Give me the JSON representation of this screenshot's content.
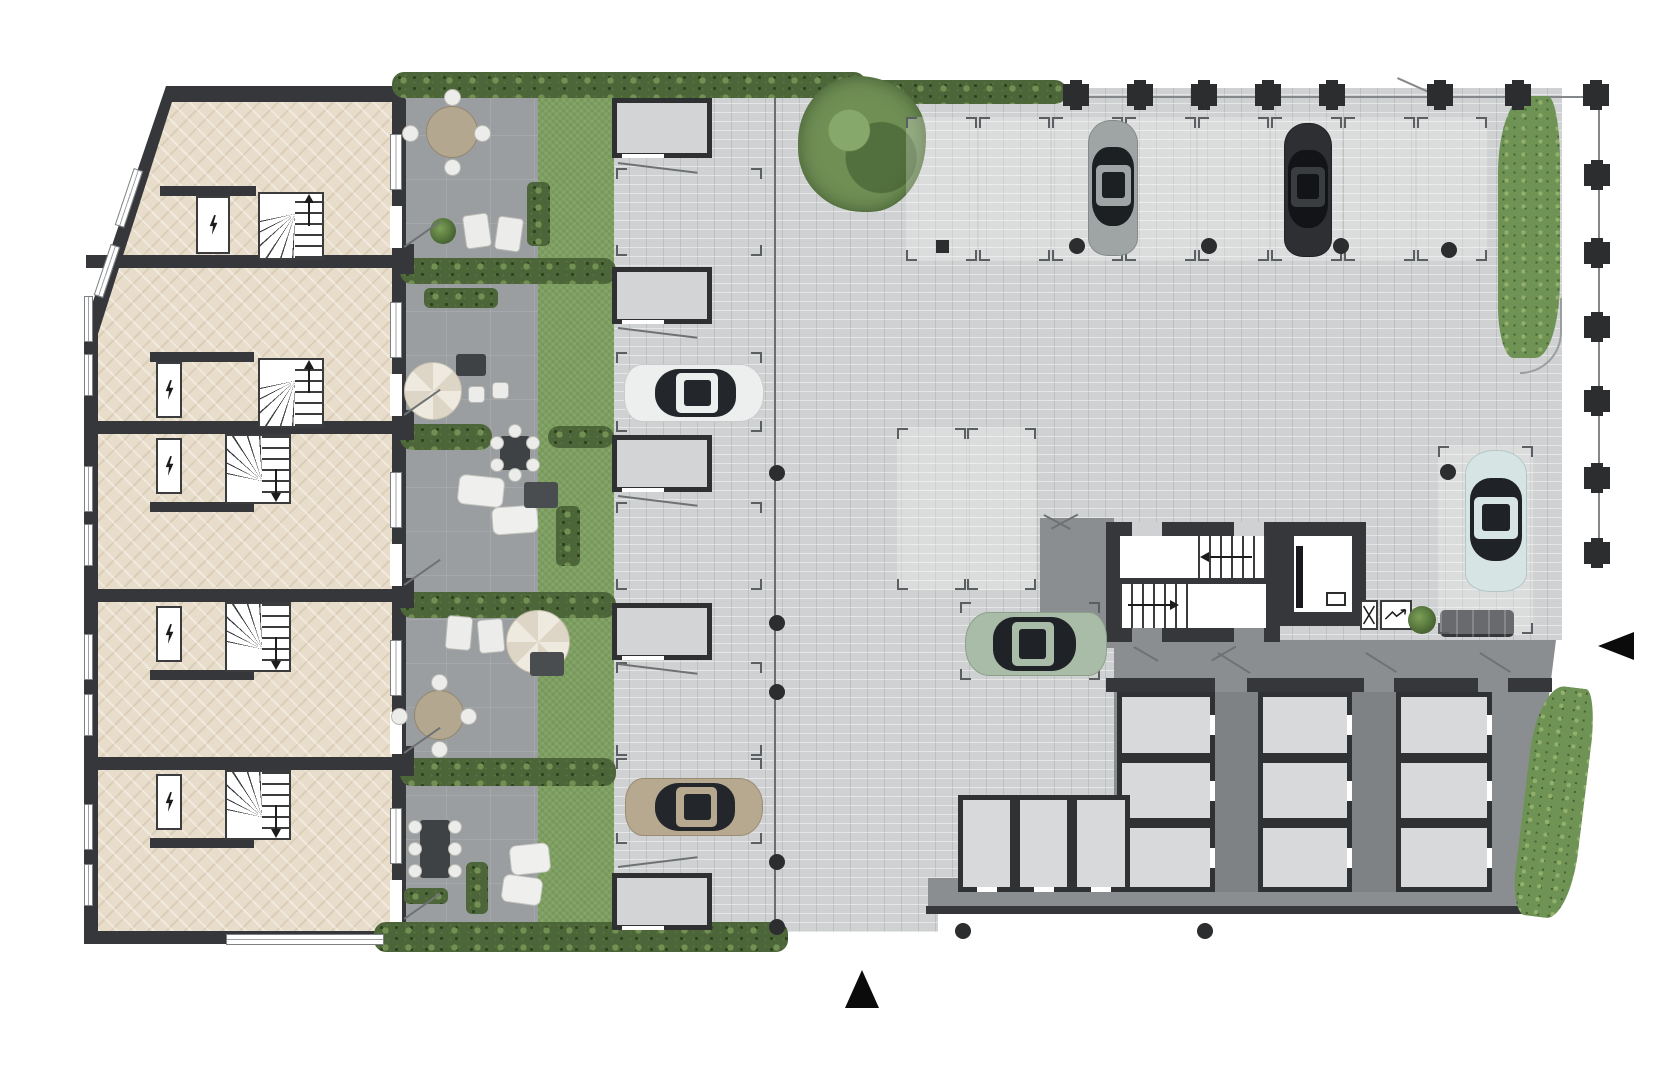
{
  "meta": {
    "name": "ground-floor-site-plan",
    "visible_text": []
  },
  "palette": {
    "wall": "#35373a",
    "wall_dark": "#2b2d2f",
    "apartment_floor": "#e8ddca",
    "terrace": "#9b9ea0",
    "lawn": "#7d9f60",
    "hedge": "#4d6639",
    "paving": "#cfd1d2",
    "walkway": "#8b8e90",
    "corridor": "#7f8285",
    "storage_cell": "#d8d9da",
    "garage": "#d3d4d5",
    "background": "#ffffff"
  },
  "site": {
    "building": {
      "dividers": [
        [
          86,
          255,
          316,
          13
        ],
        [
          86,
          421,
          316,
          13
        ],
        [
          86,
          589,
          316,
          13
        ],
        [
          86,
          757,
          316,
          13
        ]
      ],
      "units": [
        {
          "id": "unit-1",
          "y": 100,
          "hall": "bottom",
          "stair": [
            258,
            192,
            66,
            68
          ],
          "closet": [
            196,
            196,
            34,
            58
          ],
          "hallwall": [
            160,
            186,
            96,
            10
          ],
          "win": [
            390,
            134,
            12,
            56
          ],
          "door": [
            390,
            206,
            12,
            42
          ]
        },
        {
          "id": "unit-2",
          "y": 268,
          "hall": "bottom",
          "stair": [
            258,
            358,
            66,
            70
          ],
          "closet": [
            156,
            362,
            26,
            56
          ],
          "hallwall": [
            150,
            352,
            104,
            10
          ],
          "win": [
            390,
            302,
            12,
            56
          ],
          "door": [
            390,
            374,
            12,
            42
          ]
        },
        {
          "id": "unit-3",
          "y": 436,
          "hall": "top",
          "stair": [
            225,
            434,
            66,
            70
          ],
          "closet": [
            156,
            438,
            26,
            56
          ],
          "hallwall": [
            150,
            502,
            104,
            10
          ],
          "win": [
            390,
            472,
            12,
            56
          ],
          "door": [
            390,
            544,
            12,
            42
          ]
        },
        {
          "id": "unit-4",
          "y": 604,
          "hall": "top",
          "stair": [
            225,
            602,
            66,
            70
          ],
          "closet": [
            156,
            606,
            26,
            56
          ],
          "hallwall": [
            150,
            670,
            104,
            10
          ],
          "win": [
            390,
            640,
            12,
            56
          ],
          "door": [
            390,
            712,
            12,
            42
          ]
        },
        {
          "id": "unit-5",
          "y": 772,
          "hall": "top",
          "stair": [
            225,
            770,
            66,
            70
          ],
          "closet": [
            156,
            774,
            26,
            56
          ],
          "hallwall": [
            150,
            838,
            104,
            10
          ],
          "win": [
            390,
            808,
            12,
            56
          ],
          "door": [
            390,
            880,
            12,
            42
          ]
        }
      ],
      "windows_left": [
        [
          84,
          296,
          9,
          46,
          0
        ],
        [
          84,
          354,
          9,
          42,
          0
        ],
        [
          84,
          466,
          9,
          46,
          0
        ],
        [
          84,
          524,
          9,
          42,
          0
        ],
        [
          84,
          634,
          9,
          46,
          0
        ],
        [
          84,
          694,
          9,
          42,
          0
        ],
        [
          84,
          804,
          9,
          46,
          0
        ],
        [
          84,
          864,
          9,
          42,
          0
        ],
        [
          124,
          168,
          10,
          60,
          18.5
        ],
        [
          102,
          244,
          10,
          54,
          18.5
        ]
      ],
      "window_bottom": [
        226,
        934,
        158,
        11
      ],
      "piers": [
        [
          398,
          244,
          16,
          30
        ],
        [
          398,
          410,
          16,
          30
        ],
        [
          398,
          578,
          16,
          30
        ],
        [
          398,
          746,
          16,
          30
        ]
      ]
    },
    "hedges": [
      [
        392,
        72,
        474,
        26
      ],
      [
        863,
        80,
        204,
        24
      ],
      [
        400,
        258,
        216,
        26
      ],
      [
        400,
        424,
        92,
        26
      ],
      [
        548,
        426,
        66,
        22
      ],
      [
        400,
        592,
        216,
        26
      ],
      [
        400,
        758,
        216,
        28
      ],
      [
        374,
        922,
        414,
        30
      ]
    ],
    "grass": [
      [
        1498,
        96,
        62,
        262,
        0
      ],
      [
        1524,
        686,
        60,
        232,
        7
      ]
    ],
    "tree": [
      798,
      76,
      128,
      136
    ],
    "furniture": [
      {
        "t": "round-table",
        "x": 426,
        "y": 106,
        "w": 52,
        "h": 52
      },
      {
        "t": "lounge-pair",
        "x": 464,
        "y": 214,
        "w": 58,
        "h": 34,
        "r": -8
      },
      {
        "t": "planter",
        "x": 527,
        "y": 182,
        "w": 23,
        "h": 64
      },
      {
        "t": "plant",
        "x": 430,
        "y": 218,
        "w": 26,
        "h": 26
      },
      {
        "t": "planter",
        "x": 424,
        "y": 288,
        "w": 74,
        "h": 20
      },
      {
        "t": "parasol",
        "x": 404,
        "y": 362,
        "w": 58,
        "h": 58
      },
      {
        "t": "small-table",
        "x": 456,
        "y": 354,
        "w": 30,
        "h": 22
      },
      {
        "t": "chair",
        "x": 468,
        "y": 386,
        "w": 17,
        "h": 17
      },
      {
        "t": "chair",
        "x": 492,
        "y": 382,
        "w": 17,
        "h": 17
      },
      {
        "t": "dining-s",
        "x": 492,
        "y": 430,
        "w": 46,
        "h": 46
      },
      {
        "t": "sofa",
        "x": 458,
        "y": 476,
        "w": 46,
        "h": 30,
        "r": 6
      },
      {
        "t": "sofa",
        "x": 492,
        "y": 506,
        "w": 46,
        "h": 28,
        "r": -4
      },
      {
        "t": "mat",
        "x": 524,
        "y": 482,
        "w": 34,
        "h": 26
      },
      {
        "t": "planter",
        "x": 556,
        "y": 506,
        "w": 24,
        "h": 60
      },
      {
        "t": "lounge-pair",
        "x": 446,
        "y": 616,
        "w": 58,
        "h": 34,
        "r": 5
      },
      {
        "t": "parasol",
        "x": 506,
        "y": 610,
        "w": 64,
        "h": 64
      },
      {
        "t": "mat",
        "x": 530,
        "y": 652,
        "w": 34,
        "h": 24
      },
      {
        "t": "round-table",
        "x": 414,
        "y": 690,
        "w": 50,
        "h": 50
      },
      {
        "t": "dining-v",
        "x": 412,
        "y": 816,
        "w": 46,
        "h": 66
      },
      {
        "t": "sofa",
        "x": 510,
        "y": 844,
        "w": 40,
        "h": 30,
        "r": -6
      },
      {
        "t": "sofa",
        "x": 502,
        "y": 876,
        "w": 40,
        "h": 28,
        "r": 8
      },
      {
        "t": "planter",
        "x": 466,
        "y": 862,
        "w": 22,
        "h": 52
      },
      {
        "t": "planter",
        "x": 404,
        "y": 888,
        "w": 44,
        "h": 16
      }
    ],
    "garages": [
      [
        612,
        98,
        100,
        60
      ],
      [
        612,
        267,
        100,
        57
      ],
      [
        612,
        435,
        100,
        57
      ],
      [
        612,
        603,
        100,
        57
      ],
      [
        612,
        873,
        100,
        57
      ]
    ],
    "cars": [
      {
        "name": "car-white",
        "x": 694,
        "y": 393,
        "len": 140,
        "wid": 58,
        "heading": "right",
        "body": "#edeeee",
        "glass": "#23262a",
        "trim": "#c9cccc",
        "roof": "#edeeee"
      },
      {
        "name": "car-tan",
        "x": 694,
        "y": 807,
        "len": 138,
        "wid": 58,
        "heading": "right",
        "body": "#b6a98f",
        "glass": "#23262a",
        "trim": "#998c72",
        "roof": "#b6a98f"
      },
      {
        "name": "car-gray",
        "x": 1113,
        "y": 188,
        "len": 136,
        "wid": 50,
        "heading": "up",
        "body": "#9fa5a5",
        "glass": "#1d2023",
        "trim": "#848a8a",
        "roof": "#9fa5a5"
      },
      {
        "name": "car-black",
        "x": 1308,
        "y": 190,
        "len": 134,
        "wid": 48,
        "heading": "up",
        "body": "#2d2f32",
        "glass": "#121417",
        "trim": "#202224",
        "roof": "#3a3d40"
      },
      {
        "name": "car-blue",
        "x": 1496,
        "y": 521,
        "len": 142,
        "wid": 62,
        "heading": "up",
        "body": "#d7e4e4",
        "glass": "#1f2226",
        "trim": "#b5c6c6",
        "roof": "#d7e4e4"
      },
      {
        "name": "car-green",
        "x": 1036,
        "y": 644,
        "len": 142,
        "wid": 64,
        "heading": "left",
        "body": "#a9bca7",
        "glass": "#1f2226",
        "trim": "#8ba08a",
        "roof": "#a9bca7"
      }
    ],
    "bollards": [
      [
        777,
        473
      ],
      [
        777,
        623
      ],
      [
        777,
        692
      ],
      [
        777,
        862
      ],
      [
        777,
        927
      ],
      [
        1077,
        246
      ],
      [
        1209,
        246
      ],
      [
        1341,
        246
      ],
      [
        1449,
        250
      ],
      [
        1448,
        472
      ],
      [
        963,
        931
      ],
      [
        1205,
        931
      ]
    ],
    "posts": [
      [
        936,
        240,
        13,
        13
      ]
    ],
    "columns": {
      "top_y": 84,
      "top_x": [
        1063,
        1127,
        1191,
        1255,
        1319,
        1427,
        1505,
        1583
      ],
      "right_x": 1584,
      "right_y": [
        164,
        242,
        316,
        390,
        467,
        542
      ]
    },
    "spaces": [
      {
        "x": 906,
        "y": 117,
        "w": 71,
        "h": 144,
        "light": true
      },
      {
        "x": 979,
        "y": 117,
        "w": 71,
        "h": 144,
        "light": true
      },
      {
        "x": 1052,
        "y": 117,
        "w": 71,
        "h": 144,
        "light": true
      },
      {
        "x": 1125,
        "y": 117,
        "w": 71,
        "h": 144,
        "light": true
      },
      {
        "x": 1198,
        "y": 117,
        "w": 71,
        "h": 144,
        "light": true
      },
      {
        "x": 1271,
        "y": 117,
        "w": 71,
        "h": 144,
        "light": true
      },
      {
        "x": 1344,
        "y": 117,
        "w": 71,
        "h": 144,
        "light": true
      },
      {
        "x": 1417,
        "y": 117,
        "w": 70,
        "h": 144,
        "light": true
      },
      {
        "x": 897,
        "y": 428,
        "w": 69,
        "h": 162,
        "light": true
      },
      {
        "x": 967,
        "y": 428,
        "w": 69,
        "h": 162,
        "light": true
      },
      {
        "x": 1438,
        "y": 446,
        "w": 95,
        "h": 188,
        "light": true
      },
      {
        "x": 960,
        "y": 602,
        "w": 140,
        "h": 78,
        "light": false
      },
      {
        "x": 616,
        "y": 168,
        "w": 146,
        "h": 88,
        "light": false
      },
      {
        "x": 616,
        "y": 352,
        "w": 146,
        "h": 80,
        "light": false
      },
      {
        "x": 616,
        "y": 502,
        "w": 146,
        "h": 88,
        "light": false
      },
      {
        "x": 616,
        "y": 662,
        "w": 146,
        "h": 94,
        "light": false
      },
      {
        "x": 616,
        "y": 758,
        "w": 146,
        "h": 86,
        "light": false
      }
    ],
    "storage": {
      "corridors": [
        [
          1215,
          692,
          43,
          200
        ],
        [
          1352,
          692,
          44,
          200
        ]
      ],
      "cells": [
        [
          1117,
          692,
          98,
          66
        ],
        [
          1117,
          758,
          98,
          65
        ],
        [
          1117,
          823,
          98,
          69
        ],
        [
          1258,
          692,
          94,
          66
        ],
        [
          1258,
          758,
          94,
          65
        ],
        [
          1258,
          823,
          94,
          69
        ],
        [
          1396,
          692,
          96,
          66
        ],
        [
          1396,
          758,
          96,
          65
        ],
        [
          1396,
          823,
          96,
          69
        ],
        [
          958,
          795,
          57,
          97
        ],
        [
          1015,
          795,
          57,
          97
        ],
        [
          1072,
          795,
          58,
          97
        ]
      ],
      "top_wall_gaps": [
        [
          1215,
          678,
          32,
          14
        ],
        [
          1364,
          678,
          30,
          14
        ],
        [
          1478,
          678,
          30,
          14
        ]
      ]
    },
    "swings": [
      [
        618,
        162,
        80,
        7
      ],
      [
        618,
        327,
        80,
        7
      ],
      [
        618,
        495,
        80,
        7
      ],
      [
        618,
        663,
        80,
        7
      ],
      [
        618,
        866,
        80,
        -7
      ],
      [
        404,
        246,
        44,
        -35
      ],
      [
        404,
        414,
        44,
        -35
      ],
      [
        404,
        584,
        44,
        -35
      ],
      [
        404,
        752,
        44,
        -35
      ],
      [
        404,
        918,
        44,
        -35
      ],
      [
        1218,
        652,
        38,
        32
      ],
      [
        1366,
        652,
        36,
        32
      ],
      [
        1480,
        652,
        36,
        32
      ],
      [
        1044,
        514,
        30,
        28
      ],
      [
        1078,
        514,
        30,
        152
      ],
      [
        1134,
        646,
        28,
        30
      ],
      [
        1236,
        646,
        28,
        150
      ]
    ],
    "arrows": [
      {
        "dir": "up",
        "x": 845,
        "y": 970
      },
      {
        "dir": "left",
        "x": 1598,
        "y": 632
      }
    ]
  }
}
